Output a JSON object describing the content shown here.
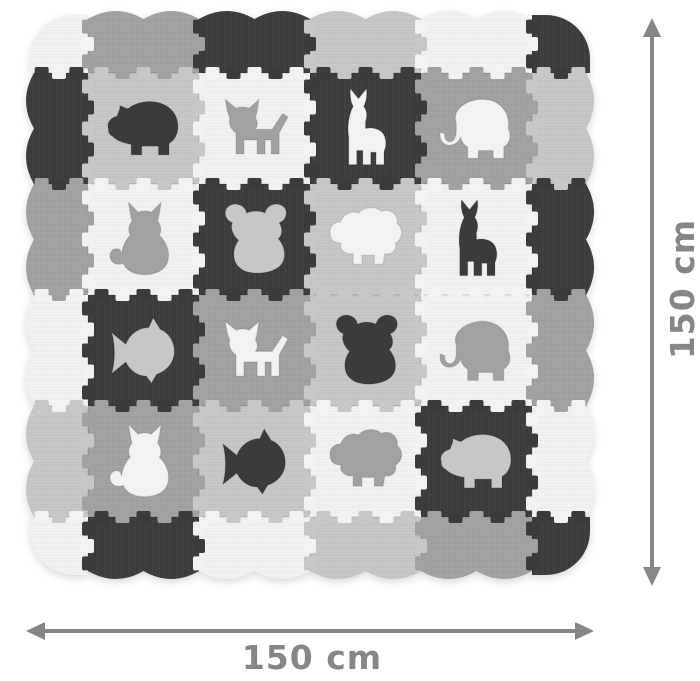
{
  "dimensions": {
    "width_label": "150 cm",
    "height_label": "150 cm",
    "arrow_color": "#868686",
    "label_color": "#868686"
  },
  "palette": {
    "white": "#f2f2f2",
    "light": "#c7c7c7",
    "mid": "#a1a1a1",
    "dark": "#3b3b3b",
    "background": "#ffffff",
    "seam_line": "rgba(0,0,0,0.16)"
  },
  "mat": {
    "corners": {
      "top_left": "white",
      "top_right": "dark",
      "bottom_left": "white",
      "bottom_right": "dark"
    },
    "edges": {
      "top": [
        "mid",
        "dark",
        "light",
        "white"
      ],
      "left": [
        "dark",
        "mid",
        "white",
        "light"
      ],
      "right": [
        "light",
        "dark",
        "mid",
        "white"
      ],
      "bottom": [
        "dark",
        "white",
        "light",
        "mid"
      ]
    },
    "tiles": [
      [
        {
          "animal": "rhino",
          "tile": "light",
          "fg": "dark"
        },
        {
          "animal": "dog",
          "tile": "white",
          "fg": "mid"
        },
        {
          "animal": "llama",
          "tile": "dark",
          "fg": "white"
        },
        {
          "animal": "elephant",
          "tile": "mid",
          "fg": "white"
        }
      ],
      [
        {
          "animal": "cat",
          "tile": "white",
          "fg": "mid"
        },
        {
          "animal": "koala",
          "tile": "dark",
          "fg": "light"
        },
        {
          "animal": "sheep",
          "tile": "light",
          "fg": "white"
        },
        {
          "animal": "llama",
          "tile": "white",
          "fg": "dark"
        }
      ],
      [
        {
          "animal": "fish",
          "tile": "dark",
          "fg": "light"
        },
        {
          "animal": "dog",
          "tile": "mid",
          "fg": "white"
        },
        {
          "animal": "koala",
          "tile": "light",
          "fg": "dark"
        },
        {
          "animal": "elephant",
          "tile": "white",
          "fg": "mid"
        }
      ],
      [
        {
          "animal": "cat",
          "tile": "mid",
          "fg": "white"
        },
        {
          "animal": "fish",
          "tile": "light",
          "fg": "dark"
        },
        {
          "animal": "sheep",
          "tile": "white",
          "fg": "mid"
        },
        {
          "animal": "rhino",
          "tile": "dark",
          "fg": "light"
        }
      ]
    ]
  }
}
